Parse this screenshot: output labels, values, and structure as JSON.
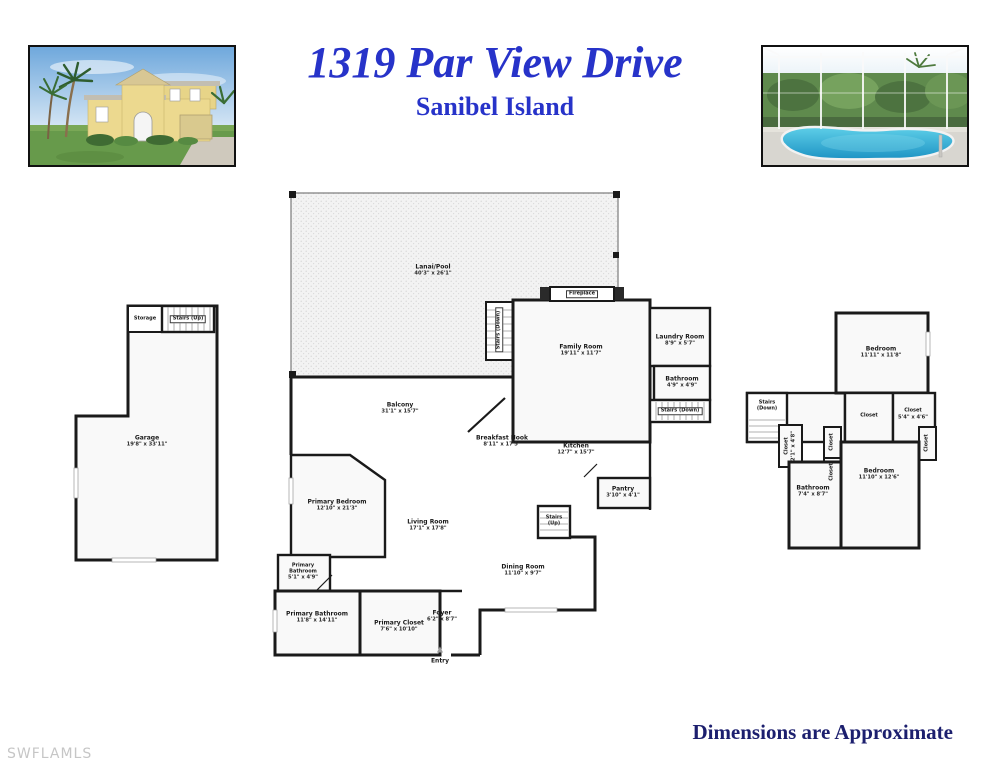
{
  "header": {
    "title": "1319 Par View Drive",
    "subtitle": "Sanibel Island"
  },
  "footer": {
    "disclaimer": "Dimensions are Approximate",
    "watermark": "SWFLAMLS"
  },
  "icons": {
    "entry_arrow": "▲"
  },
  "colors": {
    "title_blue": "#2733c9",
    "footer_navy": "#1c1f6e",
    "watermark_gray": "#c6c6c6",
    "wall_black": "#1a1a1a",
    "room_fill": "#f9f9f9"
  },
  "plan": {
    "lanai": {
      "name": "Lanai/Pool",
      "dims": "40'3\" x 26'1\""
    },
    "fireplace": {
      "name": "Fireplace"
    },
    "family_room": {
      "name": "Family Room",
      "dims": "19'11\" x 11'7\""
    },
    "laundry": {
      "name": "Laundry Room",
      "dims": "8'9\" x 5'7\""
    },
    "bathroom_main": {
      "name": "Bathroom",
      "dims": "4'9\" x 4'9\""
    },
    "stairs_down_hall": {
      "name": "Stairs (Down)"
    },
    "stairs_down_lanai": {
      "name": "Stairs (Down)"
    },
    "balcony": {
      "name": "Balcony",
      "dims": "31'1\" x 15'7\""
    },
    "breakfast_nook": {
      "name": "Breakfast Nook",
      "dims": "8'11\" x 17'5\""
    },
    "kitchen": {
      "name": "Kitchen",
      "dims": "12'7\" x 15'7\""
    },
    "pantry": {
      "name": "Pantry",
      "dims": "3'10\" x 4'1\""
    },
    "stairs_up_main": {
      "name": "Stairs (Up)"
    },
    "primary_bedroom": {
      "name": "Primary Bedroom",
      "dims": "12'10\" x 21'3\""
    },
    "living_room": {
      "name": "Living Room",
      "dims": "17'1\" x 17'8\""
    },
    "dining_room": {
      "name": "Dining Room",
      "dims": "11'10\" x 9'7\""
    },
    "primary_bathroom_small": {
      "name": "Primary Bathroom",
      "dims": "5'1\" x 4'9\""
    },
    "primary_bathroom": {
      "name": "Primary Bathroom",
      "dims": "11'8\" x 14'11\""
    },
    "primary_closet": {
      "name": "Primary Closet",
      "dims": "7'6\" x 10'10\""
    },
    "foyer": {
      "name": "Foyer",
      "dims": "6'2\" x 8'7\""
    },
    "entry": {
      "name": "Entry"
    },
    "garage": {
      "name": "Garage",
      "dims": "19'8\" x 33'11\""
    },
    "storage": {
      "name": "Storage"
    },
    "stairs_up_garage": {
      "name": "Stairs (Up)"
    },
    "bedroom_upper": {
      "name": "Bedroom",
      "dims": "11'11\" x 11'8\""
    },
    "stairs_down_upper": {
      "name": "Stairs (Down)"
    },
    "closet_hall": {
      "name": "Closet"
    },
    "closet_corner": {
      "name": "Closet",
      "dims": "5'4\" x 4'6\""
    },
    "closet_left": {
      "name": "Closet",
      "dims": "2'1\" x 4'8\""
    },
    "closet_mid_a": {
      "name": "Closet"
    },
    "closet_mid_b": {
      "name": "Closet"
    },
    "closet_right": {
      "name": "Closet"
    },
    "bedroom_lower": {
      "name": "Bedroom",
      "dims": "11'10\" x 12'6\""
    },
    "bathroom_upper": {
      "name": "Bathroom",
      "dims": "7'4\" x 8'7\""
    }
  }
}
